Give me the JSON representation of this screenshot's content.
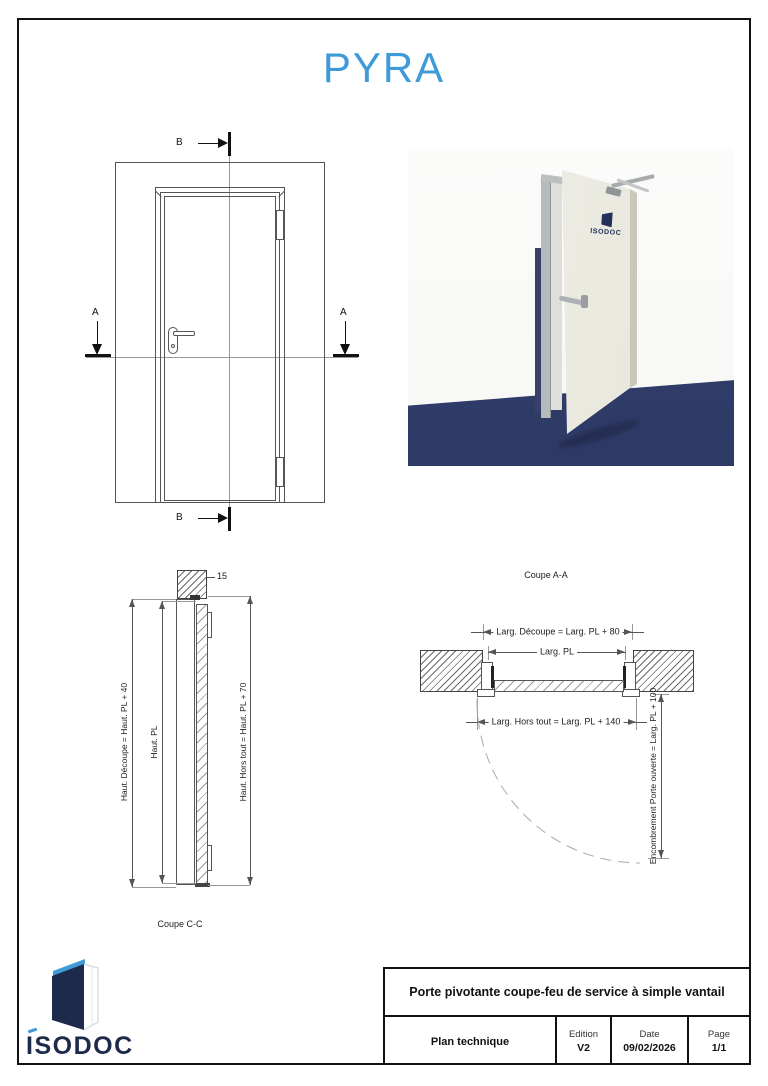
{
  "page": {
    "title": "PYRA",
    "accent_color": "#3f9bd8",
    "navy_color": "#1e2a4c",
    "render_floor_color": "#2e3a66"
  },
  "elevation": {
    "marker_a": "A",
    "marker_b": "B"
  },
  "render": {
    "door_logo_text": "ISODOC"
  },
  "coupe_cc": {
    "caption": "Coupe C-C",
    "dim_lintel": "15",
    "dim_decoupe": "Haut. Découpe = Haut. PL + 40",
    "dim_pl": "Haut. PL",
    "dim_hors_tout": "Haut. Hors tout = Haut. PL + 70"
  },
  "coupe_aa": {
    "caption": "Coupe A-A",
    "dim_decoupe": "Larg. Découpe = Larg. PL + 80",
    "dim_pl": "Larg. PL",
    "dim_hors_tout": "Larg. Hors tout = Larg. PL + 140",
    "dim_encombrement": "Encombrement Porte ouverte = Larg. PL + 100"
  },
  "logo": {
    "text": "ISODOC"
  },
  "title_block": {
    "title": "Porte pivotante coupe-feu de service à simple vantail",
    "doc_type": "Plan technique",
    "edition_label": "Edition",
    "edition_value": "V2",
    "date_label": "Date",
    "date_value": "09/02/2026",
    "page_label": "Page",
    "page_value": "1/1"
  }
}
